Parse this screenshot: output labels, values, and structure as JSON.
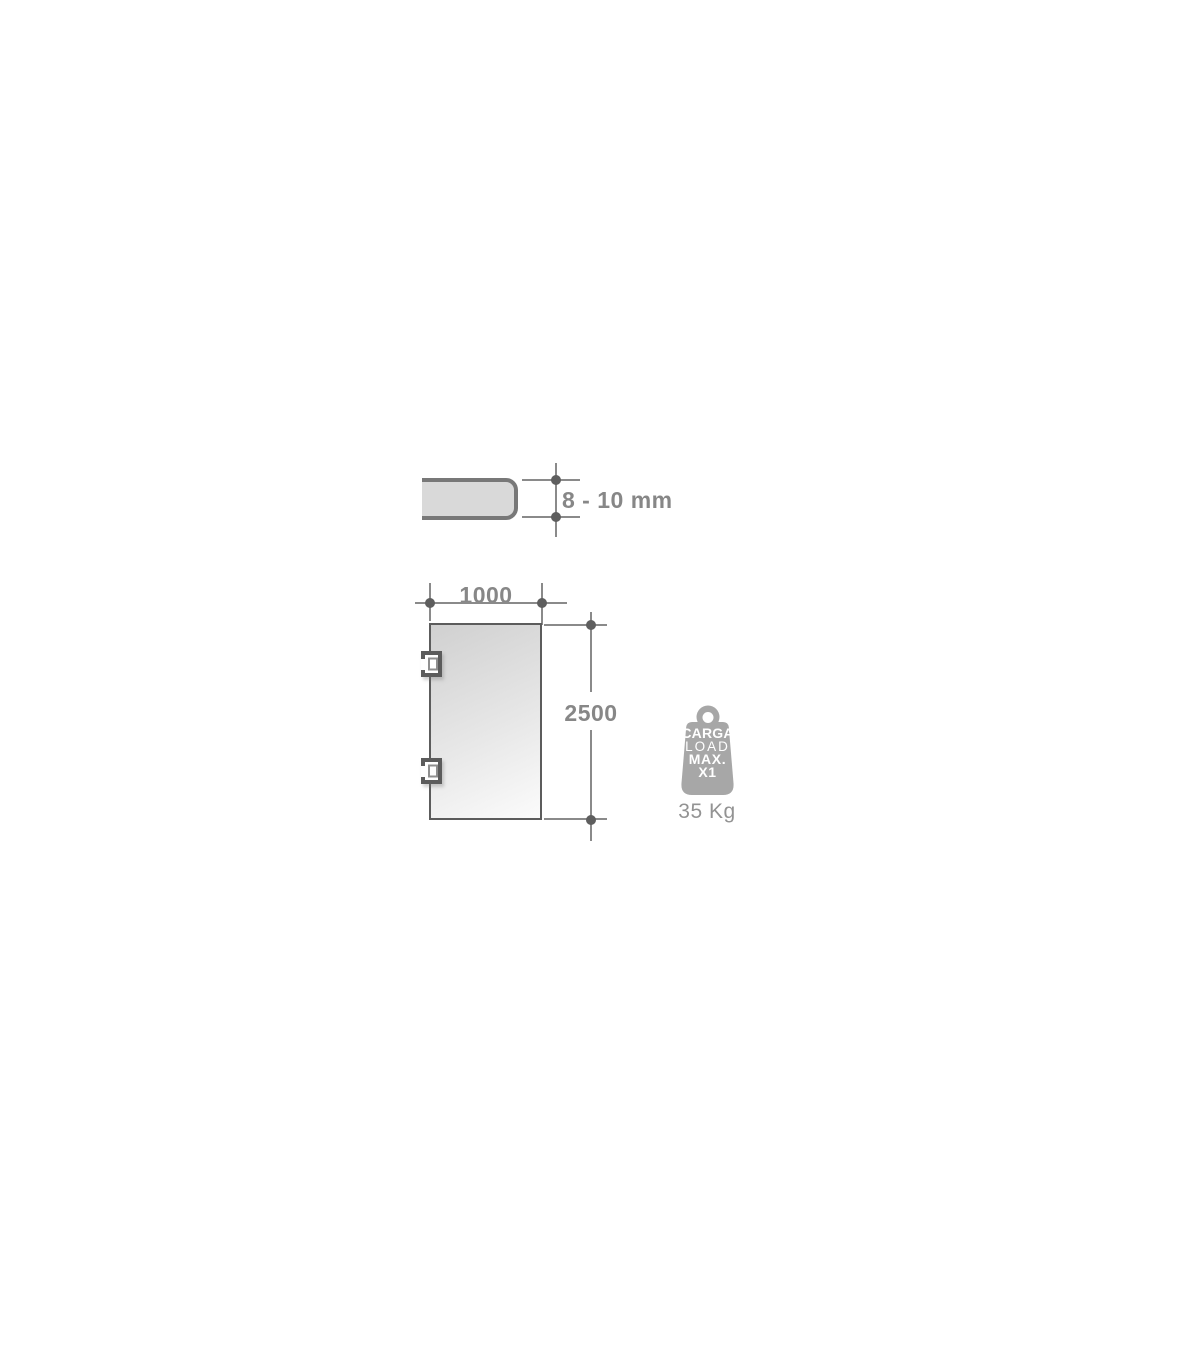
{
  "thickness_diagram": {
    "label": "8 - 10 mm"
  },
  "door_diagram": {
    "width_label": "1000",
    "height_label": "2500"
  },
  "load_badge": {
    "line1": "CARGA",
    "line2": "LOAD",
    "line3": "MAX.",
    "line4": "X1",
    "weight_label": "35 Kg"
  },
  "colors": {
    "dim_line": "#8a8a8a",
    "dim_dot": "#5e5e5e",
    "dim_text": "#878787",
    "glass_fill": "#d9d9d9",
    "glass_stroke": "#787878",
    "door_stroke": "#5c5c5c",
    "hinge_inner": "#8f8f8f",
    "badge_gray": "#a7a7a7",
    "badge_text": "#ffffff",
    "weight_text": "#939393"
  }
}
